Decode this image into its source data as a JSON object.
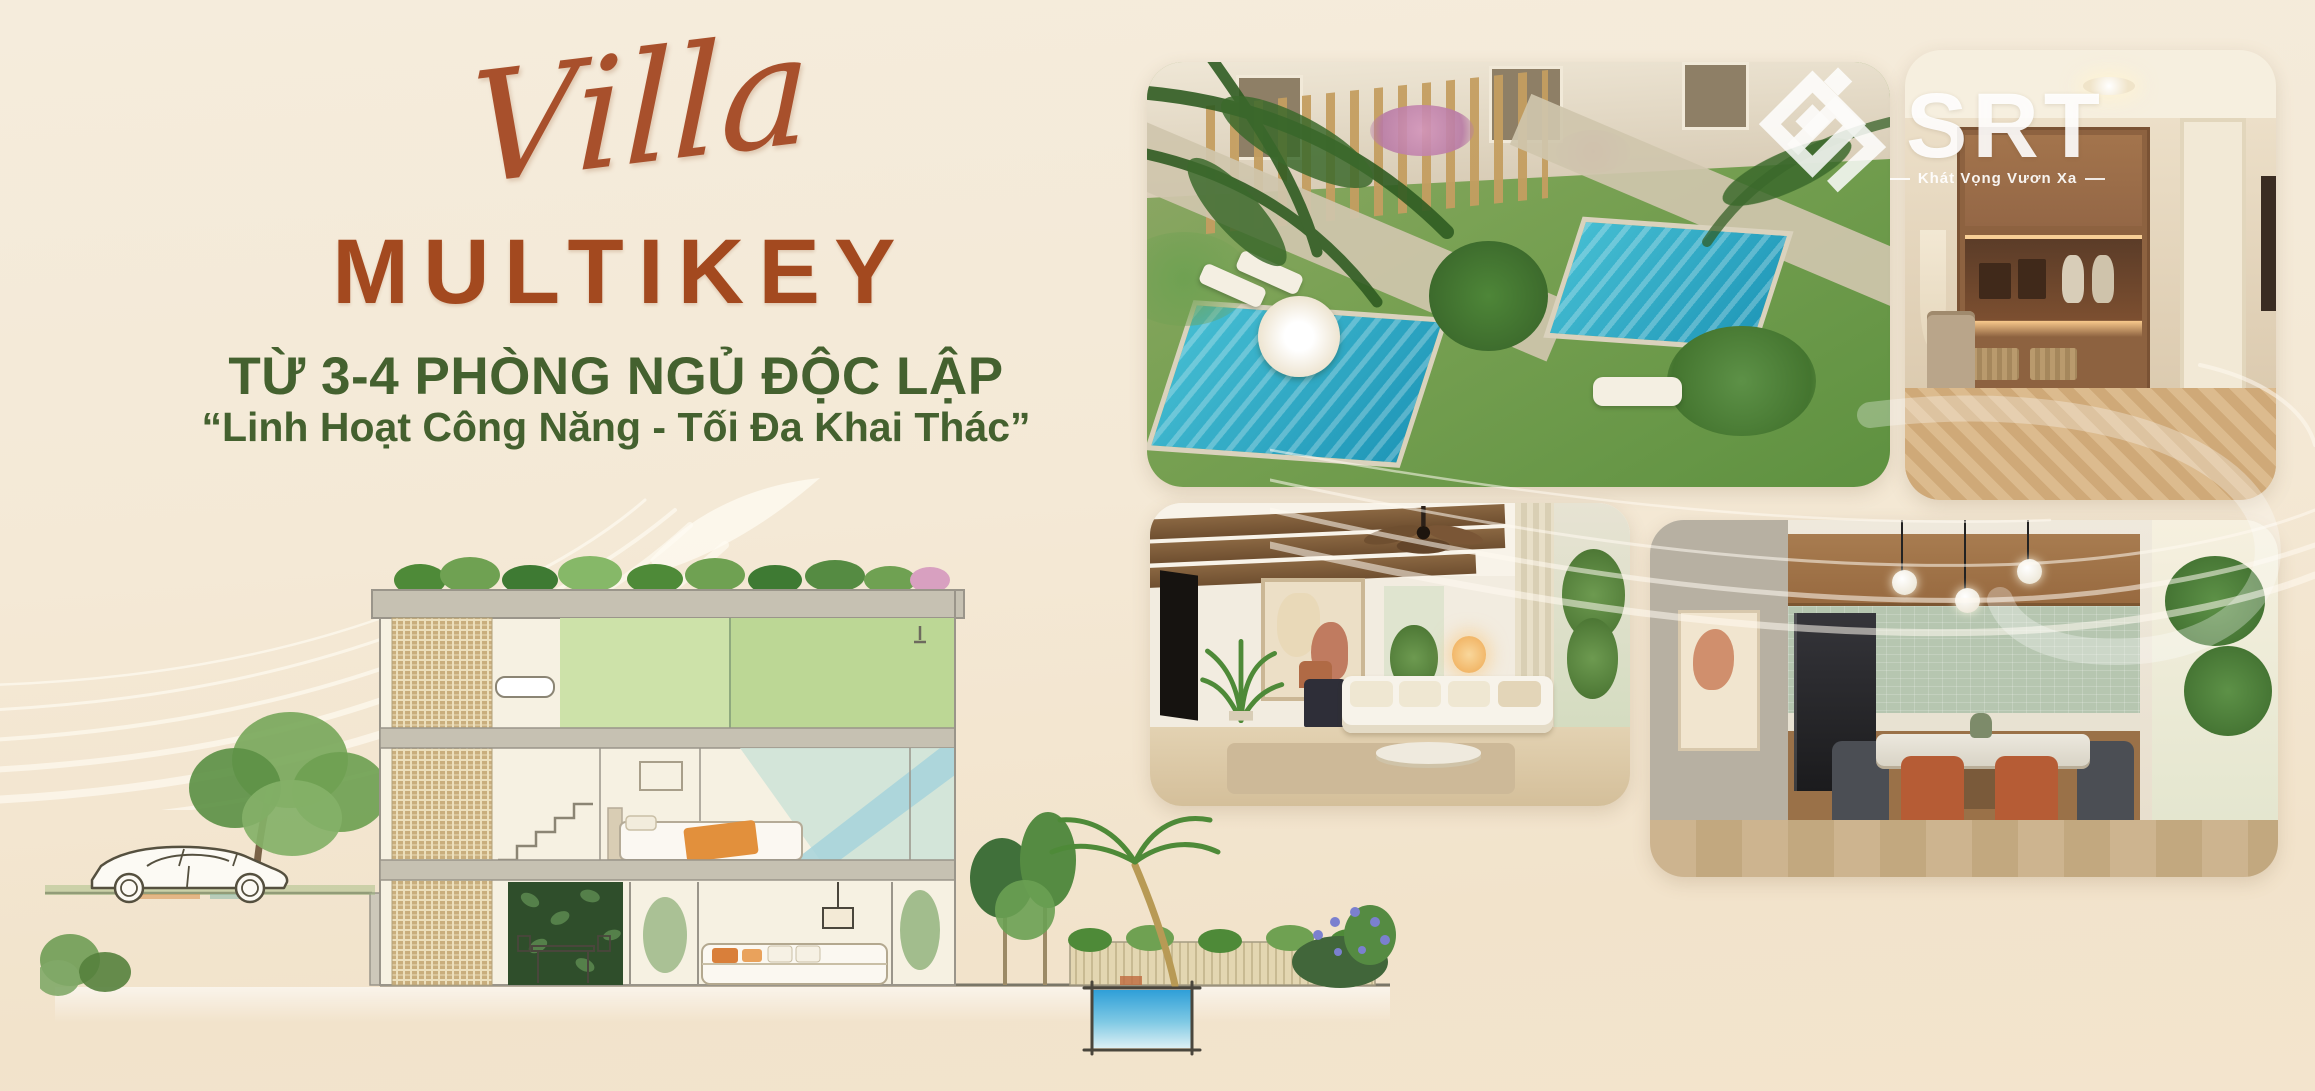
{
  "canvas": {
    "width": 2315,
    "height": 1091,
    "background_top": "#f5ecdc",
    "background_bottom": "#f2e3cb"
  },
  "title": {
    "script": "Villa",
    "main": "MULTIKEY",
    "subtitle": "TỪ 3-4 PHÒNG NGỦ ĐỘC LẬP",
    "quote": "“Linh Hoạt Công Năng - Tối Đa Khai Thác”",
    "accent_color": "#a3491f",
    "script_color": "#a8502c",
    "green_color": "#44612f"
  },
  "logo": {
    "text": "SRT",
    "tagline": "Khát Vọng Vươn Xa",
    "color": "#ffffff",
    "mark_icon": "interlocked-diamond-s"
  }
}
